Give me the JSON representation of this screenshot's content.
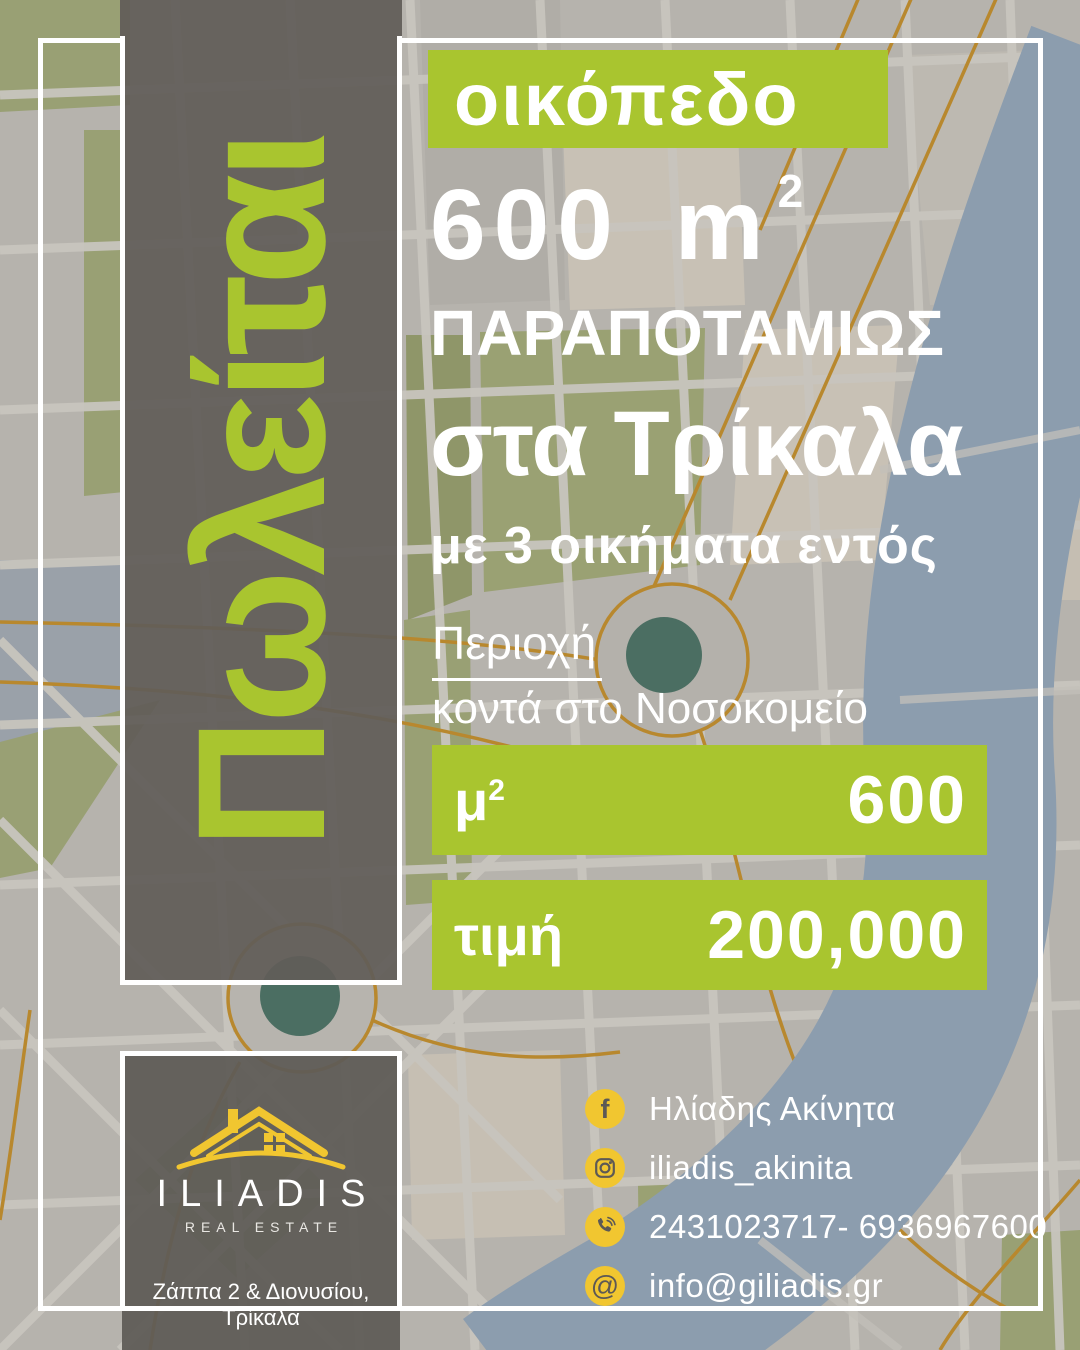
{
  "vertical_banner": {
    "text": "Πωλείται"
  },
  "headline": {
    "tag": "οικόπεδο",
    "size_number": "600",
    "size_unit": "m",
    "size_sup": "2",
    "line1": "ΠΑΡΑΠΟΤΑΜΙΩΣ",
    "line2": "στα Τρίκαλα",
    "line3": "με 3 οικήματα εντός"
  },
  "area_section": {
    "label": "Περιοχή",
    "value": "κοντά στο Νοσοκομείο"
  },
  "specs": [
    {
      "label": "μ",
      "label_sup": "2",
      "value": "600"
    },
    {
      "label": "τιμή",
      "label_sup": "",
      "value": "200,000"
    }
  ],
  "logo": {
    "name": "ILIADIS",
    "subtitle": "REAL ESTATE",
    "address": "Ζάππα 2 & Διονυσίου, Τρίκαλα"
  },
  "contacts": [
    {
      "icon": "facebook-icon",
      "text": "Ηλίαδης Ακίνητα"
    },
    {
      "icon": "instagram-icon",
      "text": "iliadis_akinita"
    },
    {
      "icon": "phone-icon",
      "text": "2431023717- 6936967600"
    },
    {
      "icon": "email-icon",
      "text": "info@giliadis.gr"
    }
  ],
  "colors": {
    "green": "#a9c52f",
    "yellow": "#f1c630",
    "teal": "#4b6e62",
    "river": "#8c9dae",
    "road": "#b8882e",
    "dark": "#5d5955"
  }
}
